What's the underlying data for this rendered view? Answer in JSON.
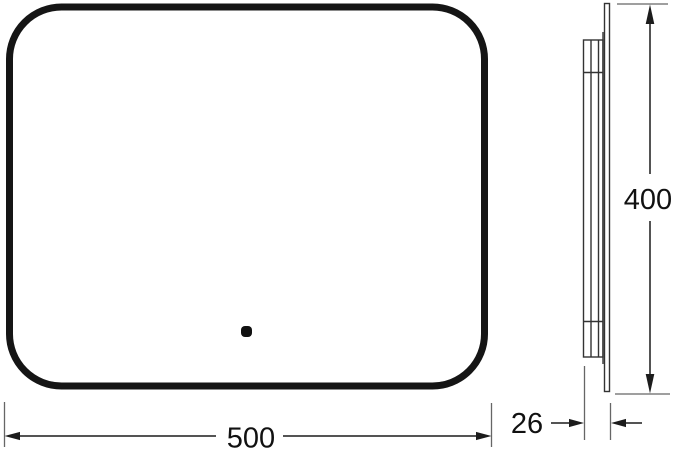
{
  "drawing": {
    "type": "technical-dimension-drawing",
    "subject": "rounded rectangular panel with touch sensor, front and side profile views",
    "dimensions": {
      "width_label": "500",
      "height_label": "400",
      "depth_label": "26"
    },
    "colors": {
      "background": "#ffffff",
      "main_outline": "#151515",
      "dimension_lines": "#1c1c1c",
      "extension_lines": "#666666",
      "profile_lines": "#333333"
    }
  }
}
